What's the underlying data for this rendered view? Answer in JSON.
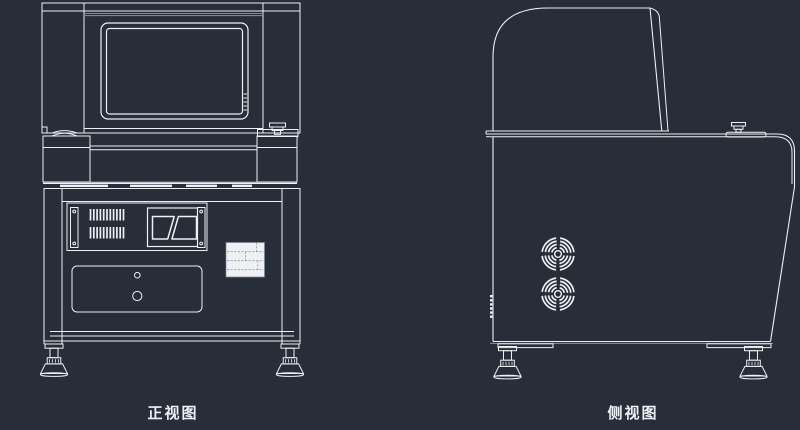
{
  "drawing": {
    "views": {
      "front": {
        "caption": "正视图"
      },
      "side": {
        "caption": "侧视图"
      }
    },
    "colors": {
      "background": "#272d39",
      "line": "#edf0f4",
      "line_gray": "#7f8795",
      "plate_fill": "#eef0f3",
      "plate_dash": "#959ba7"
    }
  }
}
